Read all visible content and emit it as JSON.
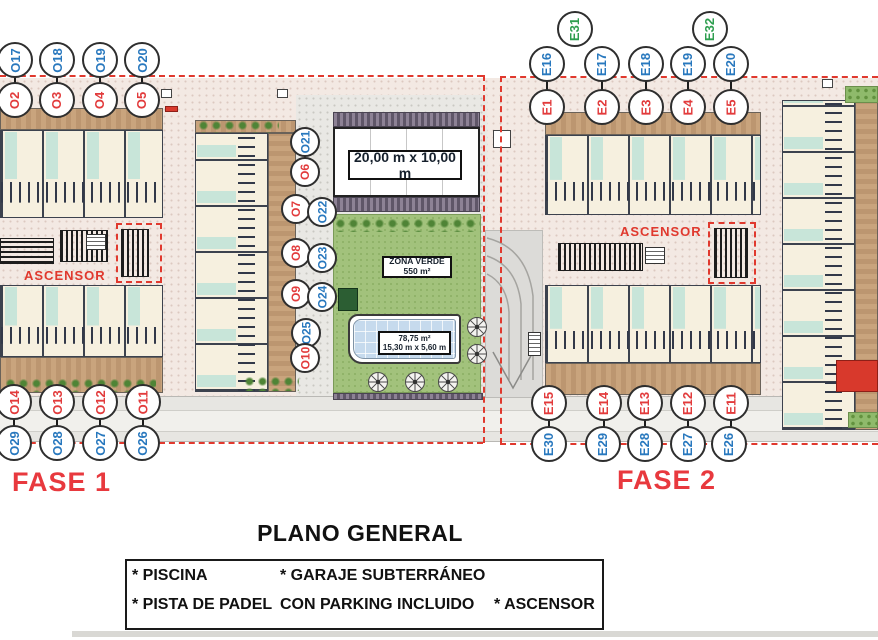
{
  "plan": {
    "title": "PLANO GENERAL",
    "fase1": "FASE 1",
    "fase2": "FASE 2",
    "ascensor1": "ASCENSOR",
    "ascensor2": "ASCENSOR",
    "padel_label": "20,00 m x 10,00 m",
    "zona_verde_line1": "ZONA VERDE",
    "zona_verde_line2": "550 m²",
    "pool_line1": "78,75 m²",
    "pool_line2": "15,30 m x 5,60 m"
  },
  "circles": {
    "tl_blue": [
      "O17",
      "O18",
      "O19",
      "O20"
    ],
    "tl_red": [
      "O2",
      "O3",
      "O4",
      "O5"
    ],
    "mid_blue": [
      "O21",
      "O22",
      "O23",
      "O24",
      "O25"
    ],
    "mid_red": [
      "O6",
      "O7",
      "O8",
      "O9",
      "O10"
    ],
    "bl_red": [
      "O14",
      "O13",
      "O12",
      "O11"
    ],
    "bl_blue": [
      "O29",
      "O28",
      "O27",
      "O26"
    ],
    "tr_green": [
      "E31",
      "E32"
    ],
    "tr_blue": [
      "E16",
      "E17",
      "E18",
      "E19",
      "E20"
    ],
    "tr_red": [
      "E1",
      "E2",
      "E3",
      "E4",
      "E5"
    ],
    "br_red": [
      "E15",
      "E14",
      "E13",
      "E12",
      "E11"
    ],
    "br_blue": [
      "E30",
      "E29",
      "E28",
      "E27",
      "E26"
    ]
  },
  "legend": {
    "piscina": "* PISCINA",
    "pista": "* PISTA DE PADEL",
    "garaje_line1": "* GARAJE SUBTERRÁNEO",
    "garaje_line2": "CON PARKING INCLUIDO",
    "ascensor": "* ASCENSOR"
  },
  "colors": {
    "marker_red": "#e23b3c",
    "marker_blue": "#2878be",
    "marker_green": "#2e9e4f",
    "boundary_dash_red": "#e0392e",
    "fase_text_red": "#e8393e"
  }
}
